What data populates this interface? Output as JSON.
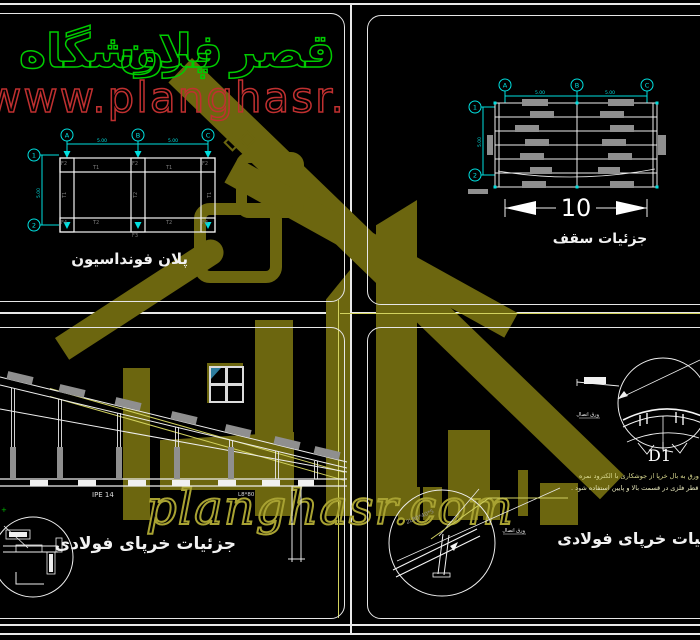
{
  "sheet": {
    "bg": "#000000",
    "line_color": "#e9e9e9"
  },
  "watermark": {
    "title_words": [
      "فروشگاه",
      "پلان",
      "قصر"
    ],
    "url_top": "www.planghasr.com",
    "url_bottom": "planghasr.com",
    "olive": "#6c660f",
    "green": "#00cc00",
    "red": "#c03030"
  },
  "foundation": {
    "caption": "پلان فونداسیون",
    "grid_top": [
      "A",
      "B",
      "C"
    ],
    "grid_side": [
      "1",
      "2"
    ],
    "dim_span1": "5.00",
    "dim_span2": "5.00",
    "dim_height": "5.00",
    "labels": {
      "t1": "T1",
      "t2": "T2",
      "f2": "F2",
      "f3": "F3",
      "f4": "F4"
    }
  },
  "ceiling": {
    "caption": "جزئیات سقف",
    "grid_top": [
      "A",
      "B",
      "C"
    ],
    "grid_side": [
      "1",
      "2"
    ],
    "dim_span1": "5.00",
    "dim_span2": "5.00",
    "dim_height": "5.00",
    "dim_total": "10"
  },
  "truss": {
    "caption": "جزئیات خرپای فولادی",
    "beam_label": "IPE 14",
    "angle_label": "L8*80",
    "marker": "+"
  },
  "details": {
    "caption": "جزئیات خرپای فولادی",
    "detail_id": "D1",
    "angle_label": "2L80*40*5",
    "plate_label": "ورق اتصال",
    "leader_label": "ورق اتصال",
    "note_line1": "برای اتصال ورق به بال خرپا از جوشکاری با الکترود نمره",
    "note_line2": "۵ یا قطر فلزی در قسمت بالا و پایین استفاده شود ."
  }
}
